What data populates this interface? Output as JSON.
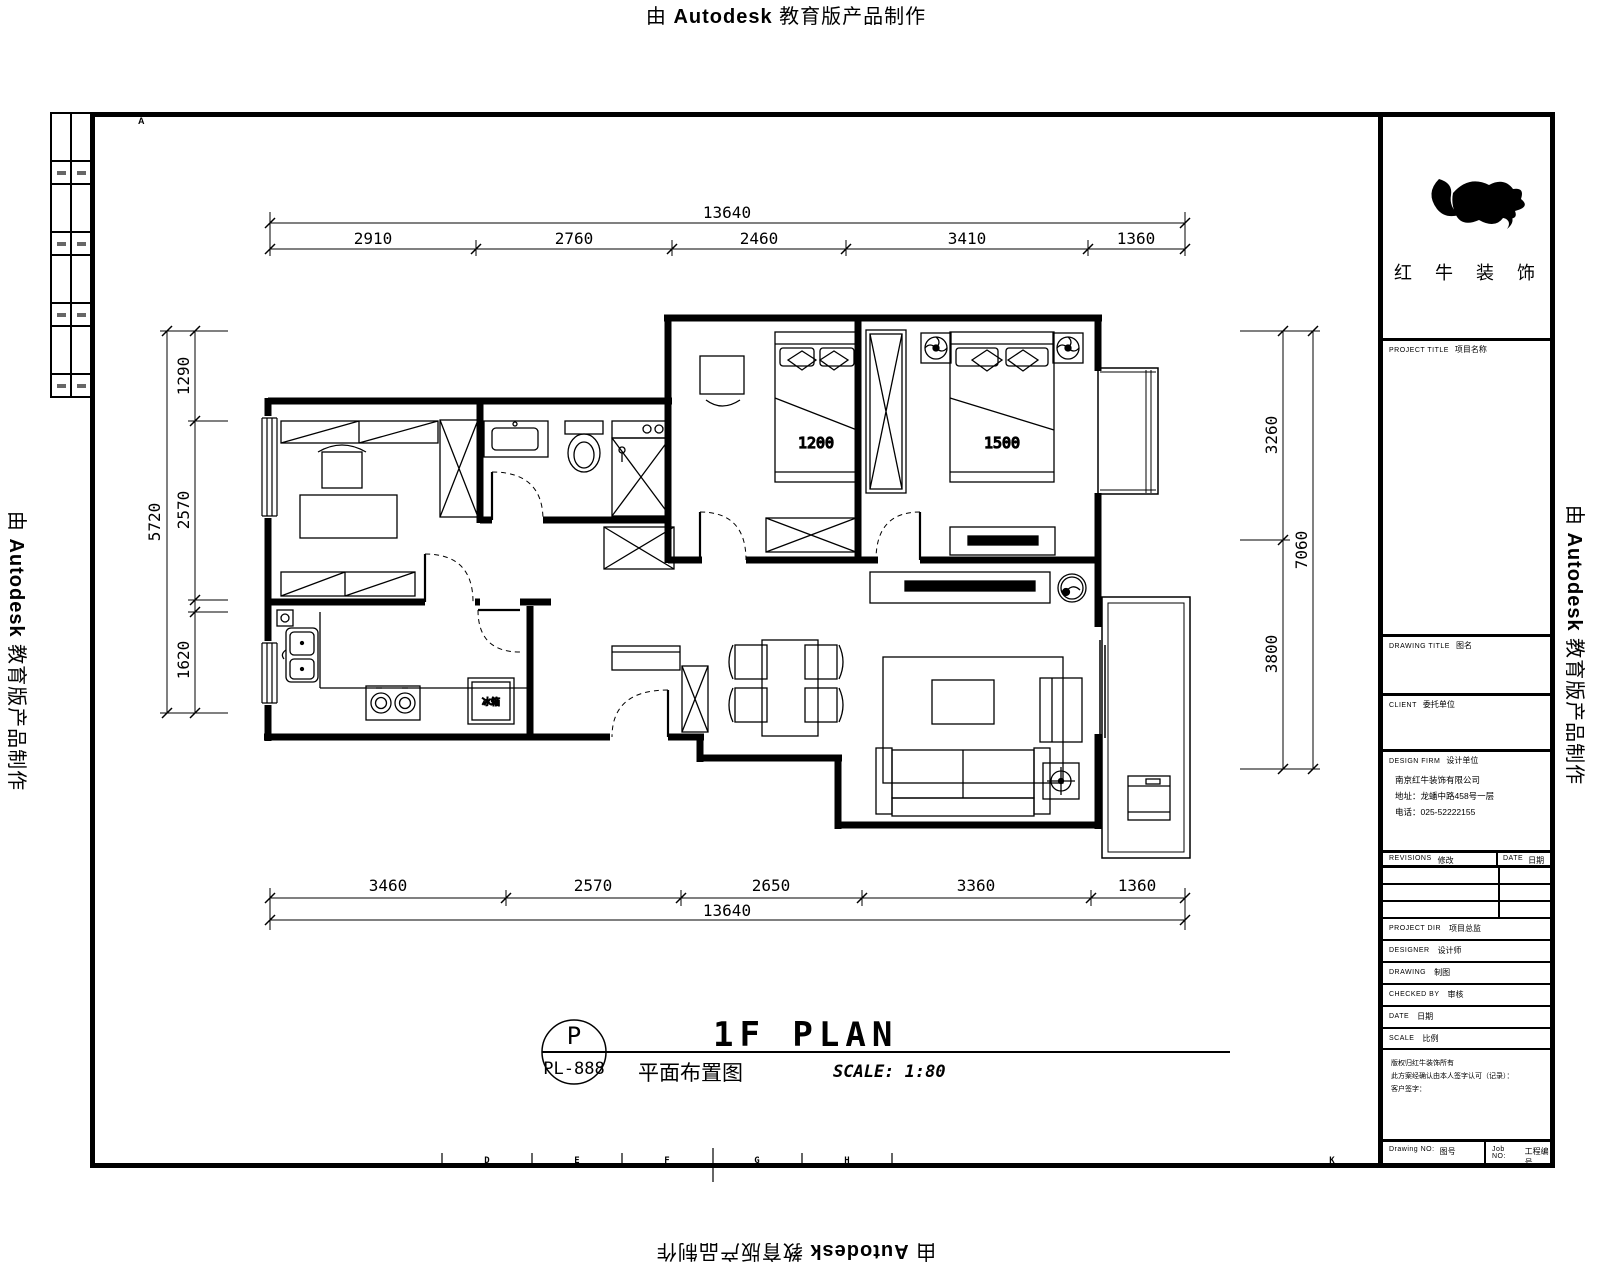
{
  "watermark": {
    "part1": "由 ",
    "brand": "Autodesk",
    "part2": " 教育版产品制作"
  },
  "grid_refs": {
    "top": "A",
    "bottom": [
      "D",
      "E",
      "F",
      "G",
      "H"
    ],
    "bottom_right": "K"
  },
  "title_block": {
    "logo_text": "红 牛 装 饰",
    "project_title": {
      "en": "PROJECT TITLE",
      "cn": "项目名称"
    },
    "drawing_title": {
      "en": "DRAWING TITLE",
      "cn": "图名"
    },
    "client": {
      "en": "CLIENT",
      "cn": "委托单位"
    },
    "design_firm": {
      "en": "DESIGN FIRM",
      "cn": "设计单位"
    },
    "company": {
      "name": "南京红牛装饰有限公司",
      "address": "地址：龙蟠中路458号一层",
      "phone": "电话：025-52222155"
    },
    "revisions": {
      "en": "REVISIONS",
      "cn": "修改"
    },
    "rev_date": {
      "en": "DATE",
      "cn": "日期"
    },
    "rows": [
      {
        "en": "PROJECT DIR",
        "cn": "项目总监"
      },
      {
        "en": "DESIGNER",
        "cn": "设计师"
      },
      {
        "en": "DRAWING",
        "cn": "制图"
      },
      {
        "en": "CHECKED BY",
        "cn": "审核"
      },
      {
        "en": "DATE",
        "cn": "日期"
      },
      {
        "en": "SCALE",
        "cn": "比例"
      }
    ],
    "notes": [
      "版权归红牛装饰所有",
      "此方案经确认由本人签字认可（记录）：",
      "客户签字："
    ],
    "drawing_no": {
      "en": "Drawing NO:",
      "cn": "图号"
    },
    "job_no": {
      "en": "Job NO:",
      "cn": "工程编号"
    }
  },
  "plan_title": {
    "bubble_letter": "P",
    "bubble_code": "PL-888",
    "title_cn": "平面布置图",
    "title_en": "1F PLAN",
    "scale_text": "SCALE: 1:80"
  },
  "room_labels": {
    "bed_small": "1200",
    "bed_large": "1500",
    "fridge": "冰箱"
  },
  "dims": {
    "top": {
      "overall": "13640",
      "segments": [
        "2910",
        "2760",
        "2460",
        "3410",
        "1360"
      ]
    },
    "bottom": {
      "overall": "13640",
      "segments": [
        "3460",
        "2570",
        "2650",
        "3360",
        "1360"
      ]
    },
    "left": {
      "overall": "5720",
      "segments": [
        "1290",
        "2570",
        "1620"
      ]
    },
    "right": {
      "overall": "7060",
      "segments": [
        "3260",
        "3800"
      ]
    }
  }
}
